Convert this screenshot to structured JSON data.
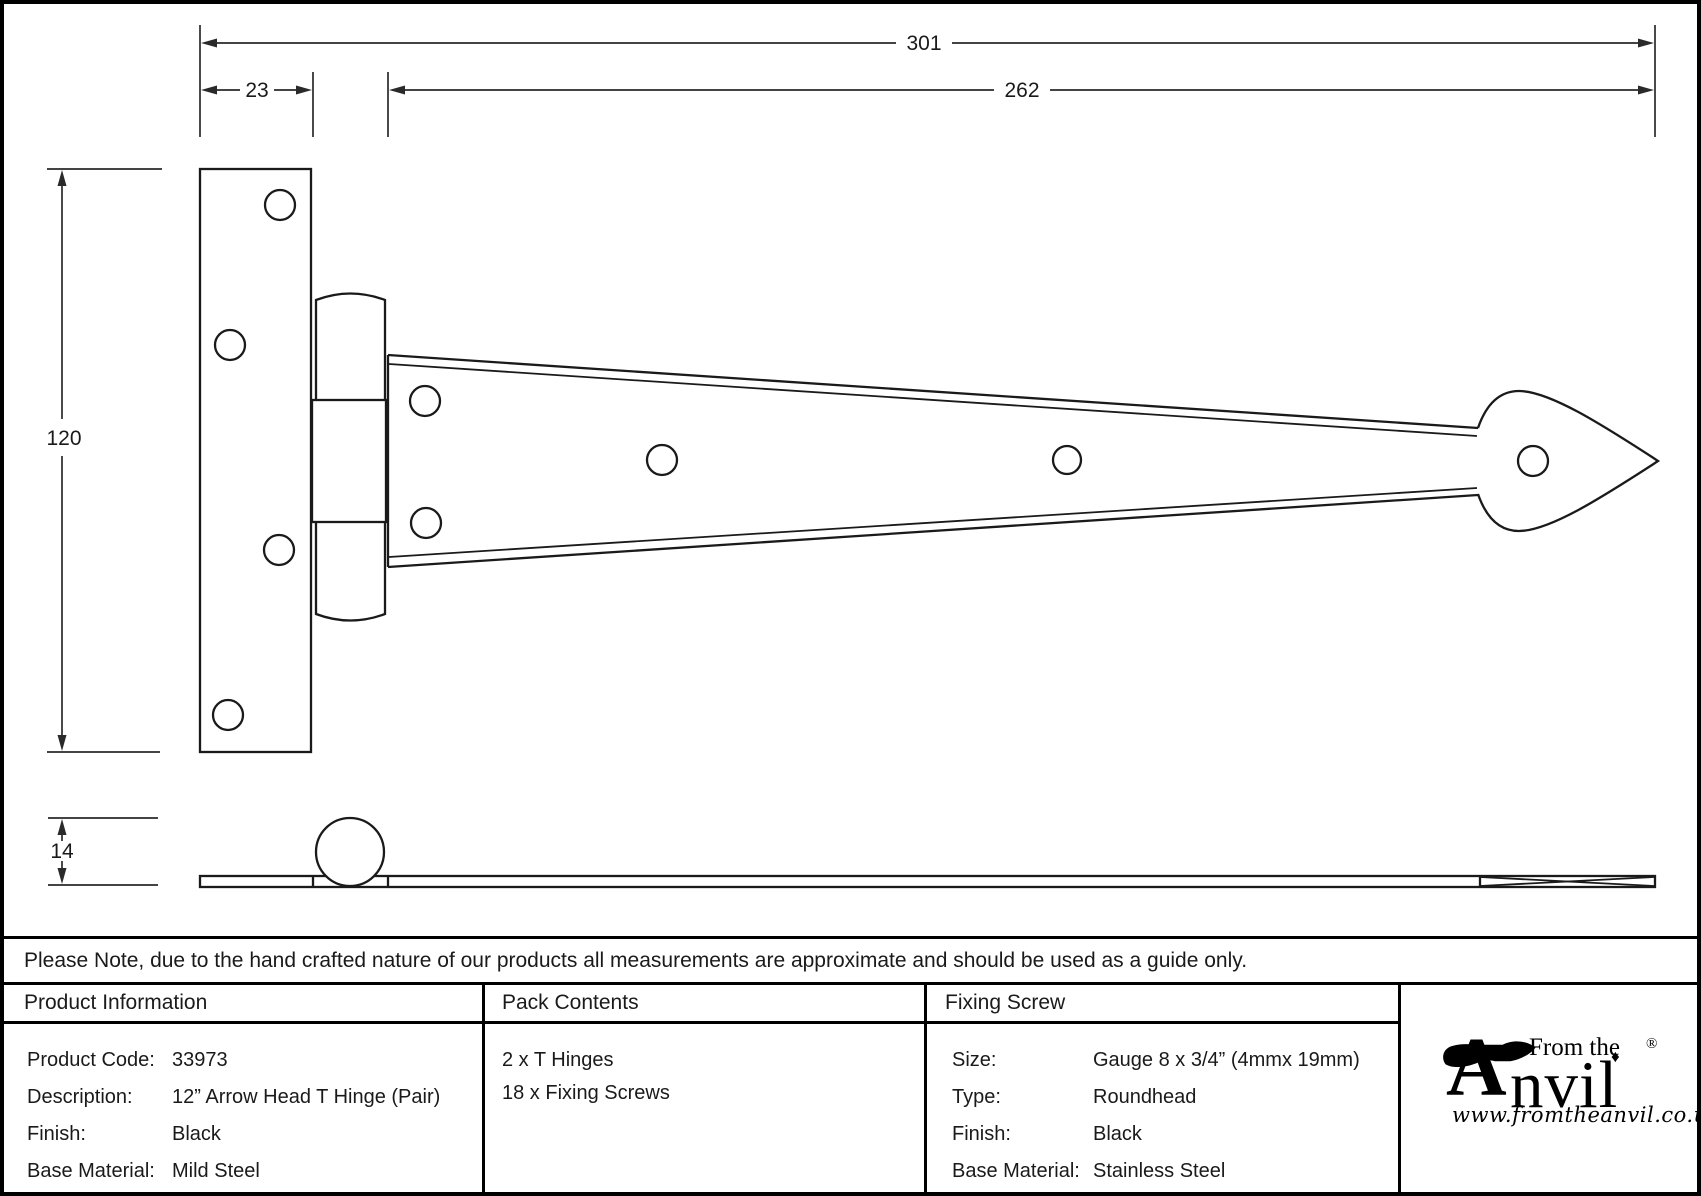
{
  "drawing": {
    "dim_total_length": "301",
    "dim_strap_length": "262",
    "dim_plate_width": "23",
    "dim_plate_height": "120",
    "dim_thickness": "14"
  },
  "note_row": {
    "text": "Please Note, due to the hand crafted nature of our products all measurements are approximate and should be used as a guide only."
  },
  "product_information": {
    "header": "Product Information",
    "rows": [
      {
        "label": "Product Code:",
        "value": "33973"
      },
      {
        "label": "Description:",
        "value": "12” Arrow Head T Hinge (Pair)"
      },
      {
        "label": "Finish:",
        "value": "Black"
      },
      {
        "label": "Base Material:",
        "value": "Mild Steel"
      }
    ]
  },
  "pack_contents": {
    "header": "Pack Contents",
    "items": [
      "2 x T Hinges",
      "18 x Fixing Screws"
    ]
  },
  "fixing_screw": {
    "header": "Fixing Screw",
    "rows": [
      {
        "label": "Size:",
        "value": "Gauge 8 x 3/4” (4mmx 19mm)"
      },
      {
        "label": "Type:",
        "value": "Roundhead"
      },
      {
        "label": "Finish:",
        "value": "Black"
      },
      {
        "label": "Base Material:",
        "value": "Stainless Steel"
      }
    ]
  },
  "logo": {
    "big_a": "A",
    "from_the": "From the",
    "anvil_rest": "nvil",
    "diamond": "♦",
    "registered": "®",
    "url": "www.fromtheanvil.co.uk"
  }
}
